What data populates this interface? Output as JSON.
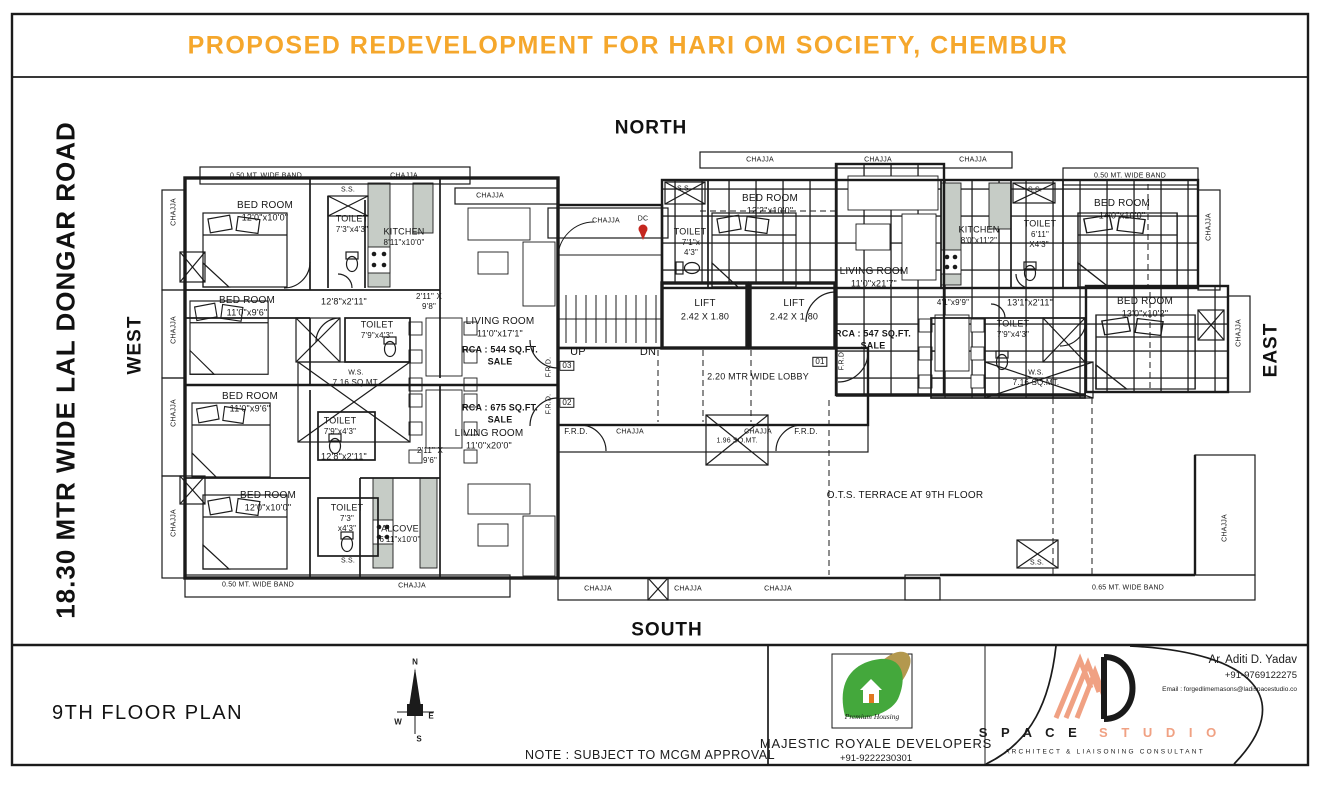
{
  "title": "PROPOSED REDEVELOPMENT FOR HARI OM SOCIETY, CHEMBUR",
  "colors": {
    "accent_orange": "#f5a72c",
    "flat_fill_cream": "#f6efdc",
    "pin_red": "#c5271f",
    "logo_green": "#44a83c",
    "logo_gold": "#b3984e",
    "studio_peach": "#f0a183",
    "line_black": "#1b1b1b"
  },
  "directions": {
    "north": "NORTH",
    "south": "SOUTH",
    "east": "EAST",
    "west": "WEST",
    "road": "18.30 MTR WIDE LAL DONGAR ROAD"
  },
  "footer": {
    "plan_name": "9TH FLOOR PLAN",
    "note": "NOTE : SUBJECT TO MCGM APPROVAL",
    "developer": {
      "tagline": "Premium Housing",
      "name": "MAJESTIC ROYALE DEVELOPERS",
      "phone": "+91-9222230301"
    },
    "studio": {
      "word1": "S P A C E",
      "word2": "S T U D I O",
      "subtitle": "ARCHITECT & LIAISONING CONSULTANT"
    },
    "architect": {
      "name": "Ar. Aditi D. Yadav",
      "phone": "+91-9769122275",
      "email": "Email : forgedlimemasons@ladispacestudio.co"
    },
    "compass": {
      "n": "N",
      "e": "E",
      "s": "S",
      "w": "W"
    }
  },
  "plan": {
    "labels": [
      {
        "t": "BED ROOM",
        "x": 265,
        "y": 206,
        "s": 10
      },
      {
        "t": "12'0\"x10'0\"",
        "x": 265,
        "y": 218,
        "s": 9
      },
      {
        "t": "TOILET",
        "x": 352,
        "y": 219,
        "s": 9
      },
      {
        "t": "7'3\"x4'3\"",
        "x": 352,
        "y": 230,
        "s": 8
      },
      {
        "t": "KITCHEN",
        "x": 404,
        "y": 232,
        "s": 9
      },
      {
        "t": "8'11\"x10'0\"",
        "x": 404,
        "y": 243,
        "s": 8
      },
      {
        "t": "S.S.",
        "x": 348,
        "y": 190,
        "s": 7
      },
      {
        "t": "LIVING ROOM",
        "x": 500,
        "y": 322,
        "s": 10
      },
      {
        "t": "11'0\"x17'1\"",
        "x": 500,
        "y": 334,
        "s": 9
      },
      {
        "t": "RCA : 544 SQ.FT.",
        "x": 500,
        "y": 350,
        "s": 9,
        "w": 1
      },
      {
        "t": "SALE",
        "x": 500,
        "y": 362,
        "s": 9,
        "w": 1
      },
      {
        "t": "12'8\"x2'11\"",
        "x": 344,
        "y": 302,
        "s": 9
      },
      {
        "t": "2'11\" X",
        "x": 429,
        "y": 297,
        "s": 8
      },
      {
        "t": "9'8\"",
        "x": 429,
        "y": 307,
        "s": 8
      },
      {
        "t": "BED ROOM",
        "x": 247,
        "y": 301,
        "s": 10
      },
      {
        "t": "11'0\"x9'6\"",
        "x": 247,
        "y": 313,
        "s": 9
      },
      {
        "t": "TOILET",
        "x": 377,
        "y": 325,
        "s": 9
      },
      {
        "t": "7'9\"x4'3\"",
        "x": 377,
        "y": 336,
        "s": 8
      },
      {
        "t": "W.S.",
        "x": 356,
        "y": 373,
        "s": 7
      },
      {
        "t": "7.16 SQ.MT.",
        "x": 356,
        "y": 383,
        "s": 8
      },
      {
        "t": "BED ROOM",
        "x": 250,
        "y": 397,
        "s": 10
      },
      {
        "t": "11'0\"x9'6\"",
        "x": 250,
        "y": 409,
        "s": 9
      },
      {
        "t": "TOILET",
        "x": 340,
        "y": 421,
        "s": 9
      },
      {
        "t": "7'9\"x4'3\"",
        "x": 340,
        "y": 432,
        "s": 8
      },
      {
        "t": "12'8\"x2'11\"",
        "x": 344,
        "y": 457,
        "s": 9
      },
      {
        "t": "2'11\" X",
        "x": 430,
        "y": 451,
        "s": 8
      },
      {
        "t": "9'6\"",
        "x": 430,
        "y": 461,
        "s": 8
      },
      {
        "t": "RCA : 675 SQ.FT.",
        "x": 500,
        "y": 408,
        "s": 9,
        "w": 1
      },
      {
        "t": "SALE",
        "x": 500,
        "y": 420,
        "s": 9,
        "w": 1
      },
      {
        "t": "LIVING ROOM",
        "x": 489,
        "y": 434,
        "s": 10
      },
      {
        "t": "11'0\"x20'0\"",
        "x": 489,
        "y": 446,
        "s": 9
      },
      {
        "t": "BED ROOM",
        "x": 268,
        "y": 496,
        "s": 10
      },
      {
        "t": "12'0\"x10'0\"",
        "x": 268,
        "y": 508,
        "s": 9
      },
      {
        "t": "TOILET",
        "x": 347,
        "y": 508,
        "s": 9
      },
      {
        "t": "7'3\"",
        "x": 347,
        "y": 519,
        "s": 8
      },
      {
        "t": "x4'3\"",
        "x": 347,
        "y": 529,
        "s": 8
      },
      {
        "t": "ALCOVE",
        "x": 400,
        "y": 529,
        "s": 9
      },
      {
        "t": "6'11\"x10'0\"",
        "x": 400,
        "y": 540,
        "s": 8
      },
      {
        "t": "S.S.",
        "x": 348,
        "y": 561,
        "s": 7
      },
      {
        "t": "UP",
        "x": 578,
        "y": 353,
        "s": 11
      },
      {
        "t": "DN",
        "x": 648,
        "y": 353,
        "s": 11
      },
      {
        "t": "LIFT",
        "x": 705,
        "y": 304,
        "s": 10
      },
      {
        "t": "2.42 X 1.80",
        "x": 705,
        "y": 317,
        "s": 9
      },
      {
        "t": "LIFT",
        "x": 794,
        "y": 304,
        "s": 10
      },
      {
        "t": "2.42 X 1.80",
        "x": 794,
        "y": 317,
        "s": 9
      },
      {
        "t": "2.20 MTR WIDE LOBBY",
        "x": 758,
        "y": 377,
        "s": 9
      },
      {
        "t": "03",
        "x": 567,
        "y": 366,
        "s": 8,
        "box": 1
      },
      {
        "t": "02",
        "x": 567,
        "y": 403,
        "s": 8,
        "box": 1
      },
      {
        "t": "01",
        "x": 820,
        "y": 362,
        "s": 8,
        "box": 1
      },
      {
        "t": "F.R.D.",
        "x": 549,
        "y": 367,
        "s": 7,
        "r": -90
      },
      {
        "t": "F.R.D.",
        "x": 549,
        "y": 404,
        "s": 7,
        "r": -90
      },
      {
        "t": "F.R.D.",
        "x": 576,
        "y": 432,
        "s": 8
      },
      {
        "t": "F.R.D.",
        "x": 806,
        "y": 432,
        "s": 8
      },
      {
        "t": "F.R.D.",
        "x": 842,
        "y": 360,
        "s": 7,
        "r": -90
      },
      {
        "t": "1.96 SQ.MT.",
        "x": 737,
        "y": 441,
        "s": 7
      },
      {
        "t": "DC",
        "x": 643,
        "y": 219,
        "s": 7
      },
      {
        "t": "CHAJJA",
        "x": 606,
        "y": 221,
        "s": 7
      },
      {
        "t": "S.S.",
        "x": 684,
        "y": 189,
        "s": 7
      },
      {
        "t": "BED ROOM",
        "x": 770,
        "y": 199,
        "s": 10
      },
      {
        "t": "12'2\"x10'0\"",
        "x": 770,
        "y": 211,
        "s": 9
      },
      {
        "t": "TOILET",
        "x": 690,
        "y": 232,
        "s": 9
      },
      {
        "t": "7'1\"x",
        "x": 691,
        "y": 243,
        "s": 8
      },
      {
        "t": "4'3\"",
        "x": 691,
        "y": 253,
        "s": 8
      },
      {
        "t": "LIVING ROOM",
        "x": 874,
        "y": 272,
        "s": 10
      },
      {
        "t": "11'0\"x21'7\"",
        "x": 874,
        "y": 284,
        "s": 9
      },
      {
        "t": "RCA : 547 SQ.FT.",
        "x": 873,
        "y": 334,
        "s": 9,
        "w": 1
      },
      {
        "t": "SALE",
        "x": 873,
        "y": 346,
        "s": 9,
        "w": 1
      },
      {
        "t": "KITCHEN",
        "x": 979,
        "y": 230,
        "s": 9
      },
      {
        "t": "8'0\"x11'2\"",
        "x": 979,
        "y": 241,
        "s": 8
      },
      {
        "t": "TOILET",
        "x": 1040,
        "y": 224,
        "s": 9
      },
      {
        "t": "6'11\"",
        "x": 1040,
        "y": 235,
        "s": 8
      },
      {
        "t": "X4'3\"",
        "x": 1039,
        "y": 245,
        "s": 8
      },
      {
        "t": "S.S.",
        "x": 1035,
        "y": 190,
        "s": 7
      },
      {
        "t": "BED ROOM",
        "x": 1122,
        "y": 204,
        "s": 10
      },
      {
        "t": "14'0\"x10'0\"",
        "x": 1122,
        "y": 216,
        "s": 9
      },
      {
        "t": "BED ROOM",
        "x": 1145,
        "y": 302,
        "s": 10
      },
      {
        "t": "13'0\"x10'2\"",
        "x": 1145,
        "y": 314,
        "s": 9
      },
      {
        "t": "13'1\"x2'11\"",
        "x": 1030,
        "y": 303,
        "s": 9
      },
      {
        "t": "4'1\"x9'9\"",
        "x": 953,
        "y": 303,
        "s": 8
      },
      {
        "t": "TOILET",
        "x": 1013,
        "y": 324,
        "s": 9
      },
      {
        "t": "7'9\"x4'3\"",
        "x": 1013,
        "y": 335,
        "s": 8
      },
      {
        "t": "W.S.",
        "x": 1036,
        "y": 373,
        "s": 7
      },
      {
        "t": "7.16 SQ.MT.",
        "x": 1036,
        "y": 383,
        "s": 8
      },
      {
        "t": "0.50 MT. WIDE BAND",
        "x": 266,
        "y": 176,
        "s": 7
      },
      {
        "t": "CHAJJA",
        "x": 404,
        "y": 176,
        "s": 7
      },
      {
        "t": "CHAJJA",
        "x": 490,
        "y": 196,
        "s": 7
      },
      {
        "t": "CHAJJA",
        "x": 174,
        "y": 212,
        "s": 7,
        "r": -90
      },
      {
        "t": "CHAJJA",
        "x": 174,
        "y": 330,
        "s": 7,
        "r": -90
      },
      {
        "t": "CHAJJA",
        "x": 174,
        "y": 413,
        "s": 7,
        "r": -90
      },
      {
        "t": "CHAJJA",
        "x": 174,
        "y": 523,
        "s": 7,
        "r": -90
      },
      {
        "t": "0.50 MT. WIDE BAND",
        "x": 258,
        "y": 585,
        "s": 7
      },
      {
        "t": "CHAJJA",
        "x": 412,
        "y": 586,
        "s": 7
      },
      {
        "t": "CHAJJA",
        "x": 760,
        "y": 160,
        "s": 7
      },
      {
        "t": "CHAJJA",
        "x": 878,
        "y": 160,
        "s": 7
      },
      {
        "t": "CHAJJA",
        "x": 973,
        "y": 160,
        "s": 7
      },
      {
        "t": "0.50 MT. WIDE BAND",
        "x": 1130,
        "y": 176,
        "s": 7
      },
      {
        "t": "CHAJJA",
        "x": 1209,
        "y": 227,
        "s": 7,
        "r": -90
      },
      {
        "t": "CHAJJA",
        "x": 1239,
        "y": 333,
        "s": 7,
        "r": -90
      },
      {
        "t": "CHAJJA",
        "x": 1225,
        "y": 528,
        "s": 7,
        "r": -90
      },
      {
        "t": "O.T.S. TERRACE AT 9TH FLOOR",
        "x": 905,
        "y": 496,
        "s": 10
      },
      {
        "t": "S.S.",
        "x": 1037,
        "y": 563,
        "s": 7
      },
      {
        "t": "0.65 MT. WIDE BAND",
        "x": 1128,
        "y": 588,
        "s": 7
      },
      {
        "t": "CHAJJA",
        "x": 598,
        "y": 589,
        "s": 7
      },
      {
        "t": "CHAJJA",
        "x": 688,
        "y": 589,
        "s": 7
      },
      {
        "t": "CHAJJA",
        "x": 778,
        "y": 589,
        "s": 7
      },
      {
        "t": "CHAJJA",
        "x": 630,
        "y": 432,
        "s": 7
      },
      {
        "t": "CHAJJA",
        "x": 758,
        "y": 432,
        "s": 7
      }
    ]
  }
}
